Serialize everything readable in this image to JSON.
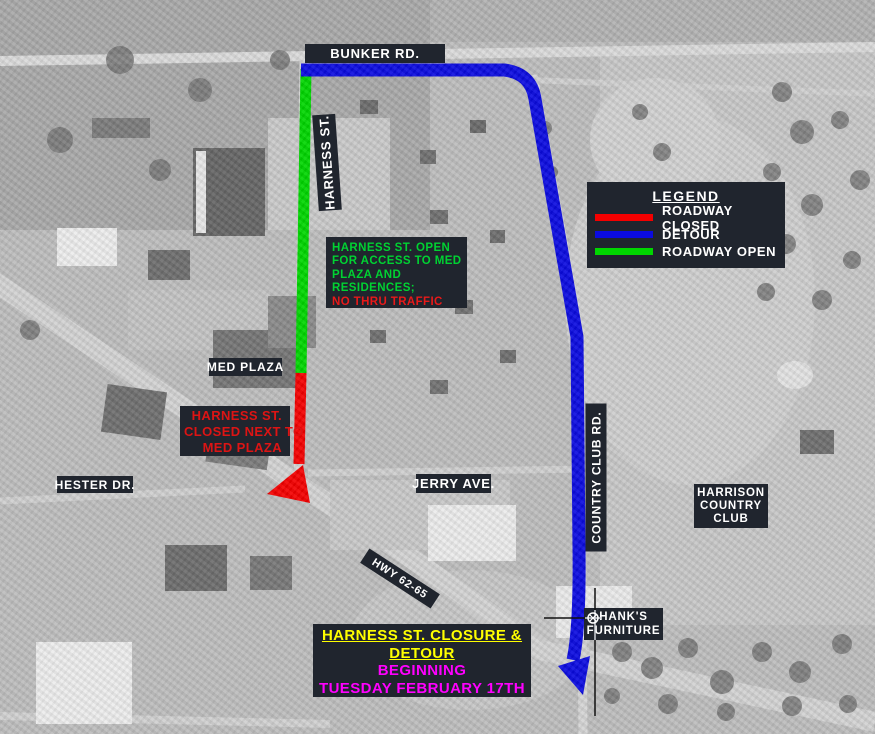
{
  "colors": {
    "label_box_bg": "#20252e",
    "label_text": "#ffffff",
    "roadway_closed": "#f40000",
    "detour": "#0b0be0",
    "roadway_open": "#00d600",
    "open_note_green": "#00d232",
    "open_note_red": "#e81919",
    "closed_note_red": "#dd1414",
    "title_yellow": "#ffff00",
    "title_magenta": "#ff00ff"
  },
  "road_labels": {
    "bunker": "BUNKER RD.",
    "harness": "HARNESS ST.",
    "country_club": "COUNTRY CLUB RD.",
    "hester": "HESTER DR.",
    "jerry": "JERRY AVE.",
    "highway": "HWY 62-65"
  },
  "place_labels": {
    "med_plaza": "MED PLAZA",
    "harrison": {
      "line1": "HARRISON",
      "line2": "COUNTRY",
      "line3": "CLUB"
    },
    "hanks": {
      "line1": "HANK'S",
      "line2": "FURNITURE"
    }
  },
  "legend": {
    "title": "LEGEND",
    "items": [
      {
        "label": "ROADWAY CLOSED",
        "color": "#f40000"
      },
      {
        "label": "DETOUR",
        "color": "#0b0be0"
      },
      {
        "label": "ROADWAY OPEN",
        "color": "#00d600"
      }
    ]
  },
  "notes": {
    "open": {
      "line1": "HARNESS ST. OPEN",
      "line2": "FOR ACCESS TO MED",
      "line3": "PLAZA AND",
      "line4": "RESIDENCES;",
      "line5": "NO THRU TRAFFIC"
    },
    "closed": {
      "line1": "HARNESS ST.",
      "line2": "CLOSED NEXT TO",
      "line3": "MED PLAZA"
    }
  },
  "title_box": {
    "line1": "HARNESS ST. CLOSURE &",
    "line2": "DETOUR",
    "line3": "BEGINNING",
    "line4": "TUESDAY FEBRUARY 17TH"
  }
}
